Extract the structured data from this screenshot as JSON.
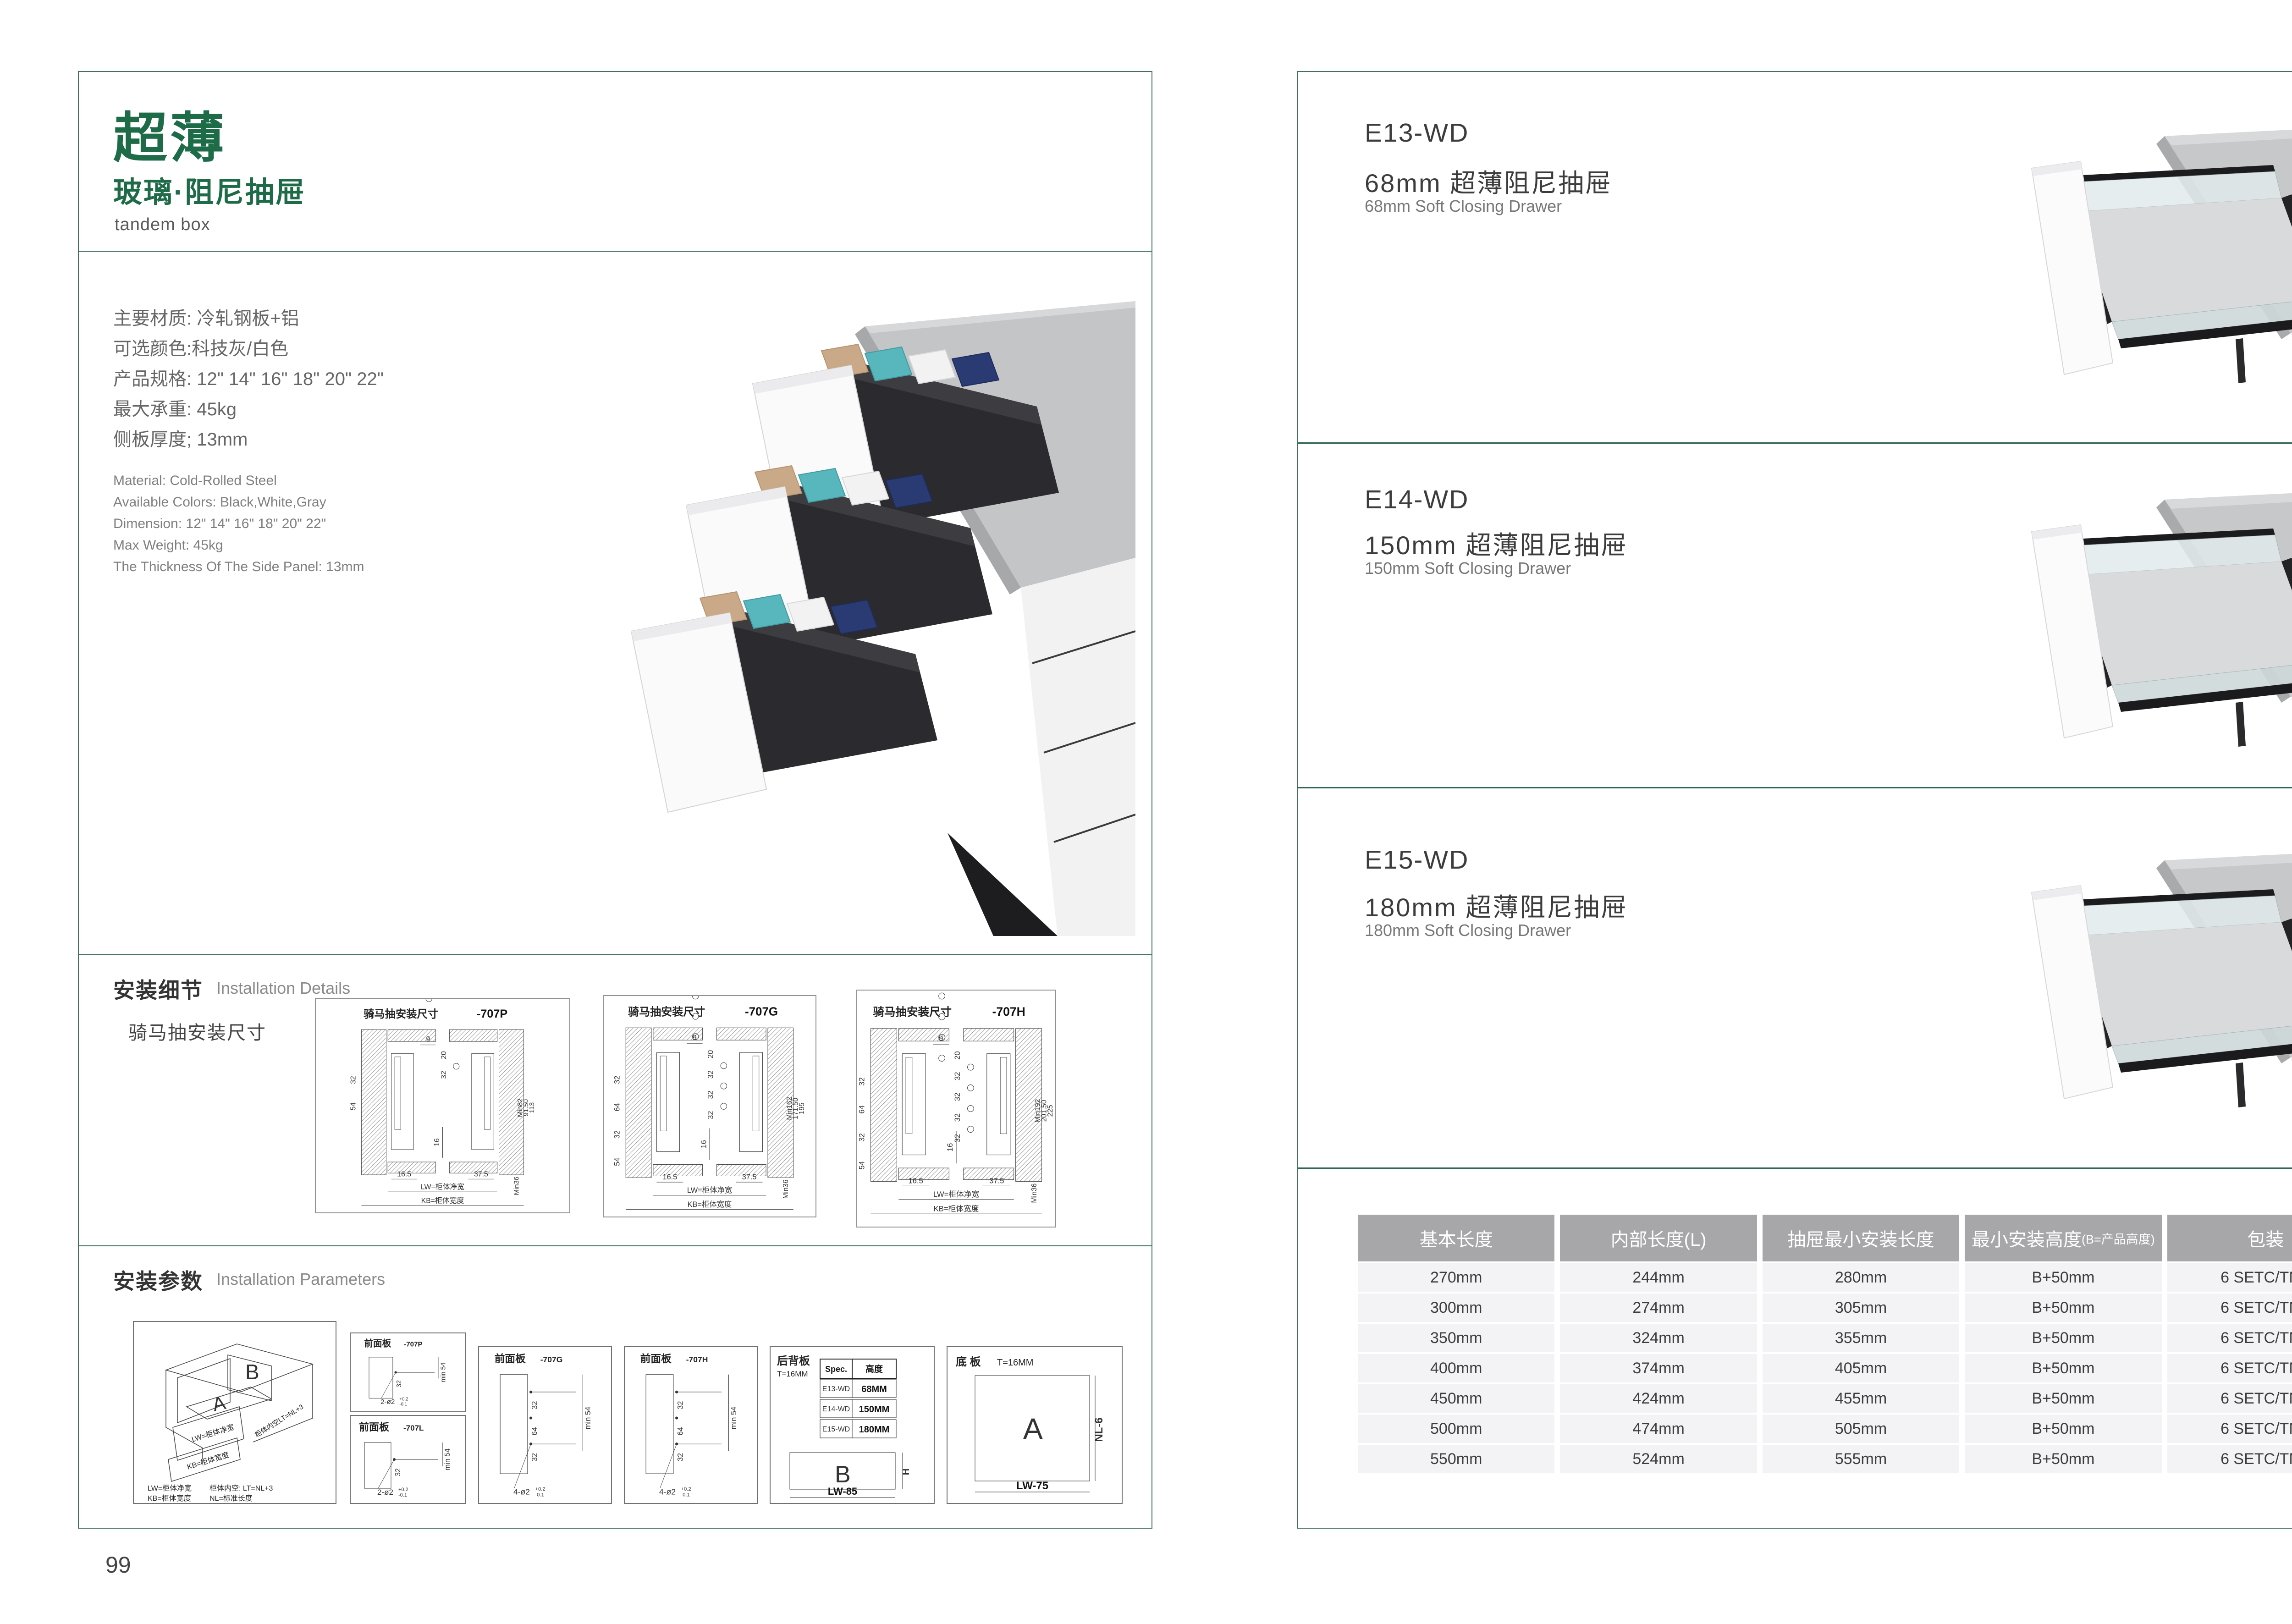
{
  "colors": {
    "accent_green": "#1e6b48",
    "border_green": "#44705c",
    "divider_green": "#2f6750",
    "table_header_bg": "#a7a7a9",
    "table_row_bg": "#f3f3f5"
  },
  "page_left": {
    "page_number": "99",
    "title_cn": "超薄",
    "subtitle_cn": "玻璃·阻尼抽屉",
    "subtitle_en": "tandem box",
    "specs_cn": [
      "主要材质: 冷轧钢板+铝",
      "可选颜色:科技灰/白色",
      "产品规格: 12\" 14\" 16\" 18\" 20\" 22\"",
      "最大承重: 45kg",
      "侧板厚度; 13mm"
    ],
    "specs_en": [
      "Material: Cold-Rolled Steel",
      "Available Colors: Black,White,Gray",
      "Dimension: 12\" 14\" 16\" 18\" 20\" 22\"",
      "Max Weight: 45kg",
      "The Thickness Of The Side Panel: 13mm"
    ],
    "install_details": {
      "title_cn": "安装细节",
      "title_en": "Installation Details",
      "subtitle": "骑马抽安装尺寸",
      "diagrams": [
        {
          "title": "骑马抽安装尺寸",
          "code": "-707P",
          "top": "9",
          "pitch": "20",
          "holes": [
            "32"
          ],
          "center": "16",
          "left": [
            "32",
            "54"
          ],
          "right": [
            "Min82",
            "91.50",
            "113"
          ],
          "bl": "16.5",
          "br": "37.5",
          "min": "Min36",
          "lw": "LW=柜体净宽",
          "kb": "KB=柜体宽度"
        },
        {
          "title": "骑马抽安装尺寸",
          "code": "-707G",
          "top": "9",
          "pitch": "20",
          "holes": [
            "32",
            "32",
            "32"
          ],
          "center": "16",
          "left": [
            "32",
            "64",
            "32",
            "54"
          ],
          "right": [
            "Min162",
            "171.50",
            "195"
          ],
          "bl": "16.5",
          "br": "37.5",
          "min": "Min36",
          "lw": "LW=柜体净宽",
          "kb": "KB=柜体宽度"
        },
        {
          "title": "骑马抽安装尺寸",
          "code": "-707H",
          "top": "9",
          "pitch": "20",
          "holes": [
            "32",
            "32",
            "32",
            "32"
          ],
          "center": "16",
          "left": [
            "32",
            "64",
            "32",
            "54"
          ],
          "right": [
            "Min192",
            "201.50",
            "225"
          ],
          "bl": "16.5",
          "br": "37.5",
          "min": "Min36",
          "lw": "LW=柜体净宽",
          "kb": "KB=柜体宽度"
        }
      ]
    },
    "install_params": {
      "title_cn": "安装参数",
      "title_en": "Installation Parameters",
      "iso": {
        "a": "A",
        "b": "B",
        "lw": "LW=柜体净宽",
        "kb": "KB=柜体宽度",
        "lt": "柜体内空LT=NL+3",
        "legend1": "LW=柜体净宽",
        "legend2": "柜体内空: LT=NL+3",
        "legend3": "KB=柜体宽度",
        "legend4": "NL=标准长度"
      },
      "panels": [
        {
          "title": "前面板",
          "code": "-707P",
          "dims": [
            "32"
          ],
          "min": "min 54",
          "qty": "2-ø2",
          "tu": "+0.2",
          "td": "-0.1"
        },
        {
          "title": "前面板",
          "code": "-707L",
          "dims": [
            "32"
          ],
          "min": "min 54",
          "qty": "2-ø2",
          "tu": "+0.2",
          "td": "-0.1"
        },
        {
          "title": "前面板",
          "code": "-707G",
          "dims": [
            "32",
            "64",
            "32"
          ],
          "min": "min 54",
          "qty": "4-ø2",
          "tu": "+0.2",
          "td": "-0.1"
        },
        {
          "title": "前面板",
          "code": "-707H",
          "dims": [
            "32",
            "64",
            "32"
          ],
          "min": "min 54",
          "qty": "4-ø2",
          "tu": "+0.2",
          "td": "-0.1"
        }
      ],
      "back_panel": {
        "title": "后背板",
        "t": "T=16MM",
        "headers": [
          "Spec.",
          "高度"
        ],
        "rows": [
          [
            "E13-WD",
            "68MM"
          ],
          [
            "E14-WD",
            "150MM"
          ],
          [
            "E15-WD",
            "180MM"
          ]
        ],
        "label": "B",
        "h": "H",
        "w": "LW-85"
      },
      "bottom_panel": {
        "title": "底 板",
        "t": "T=16MM",
        "label": "A",
        "h": "NL-6",
        "w": "LW-75"
      }
    }
  },
  "page_right": {
    "page_number": "100",
    "products": [
      {
        "model": "E13-WD",
        "name_cn": "68mm 超薄阻尼抽屉",
        "name_en": "68mm Soft Closing Drawer"
      },
      {
        "model": "E14-WD",
        "name_cn": "150mm 超薄阻尼抽屉",
        "name_en": "150mm Soft Closing Drawer"
      },
      {
        "model": "E15-WD",
        "name_cn": "180mm 超薄阻尼抽屉",
        "name_en": "180mm Soft Closing Drawer"
      }
    ],
    "table": {
      "headers": [
        "基本长度",
        "内部长度(L)",
        "抽屉最小安装长度",
        "最小安装高度",
        "包装"
      ],
      "header4_suffix": "(B=产品高度)",
      "rows": [
        [
          "270mm",
          "244mm",
          "280mm",
          "B+50mm",
          "6 SETC/TNB"
        ],
        [
          "300mm",
          "274mm",
          "305mm",
          "B+50mm",
          "6 SETC/TNB"
        ],
        [
          "350mm",
          "324mm",
          "355mm",
          "B+50mm",
          "6 SETC/TNB"
        ],
        [
          "400mm",
          "374mm",
          "405mm",
          "B+50mm",
          "6 SETC/TNB"
        ],
        [
          "450mm",
          "424mm",
          "455mm",
          "B+50mm",
          "6 SETC/TNB"
        ],
        [
          "500mm",
          "474mm",
          "505mm",
          "B+50mm",
          "6 SETC/TNB"
        ],
        [
          "550mm",
          "524mm",
          "555mm",
          "B+50mm",
          "6 SETC/TNB"
        ]
      ]
    }
  }
}
